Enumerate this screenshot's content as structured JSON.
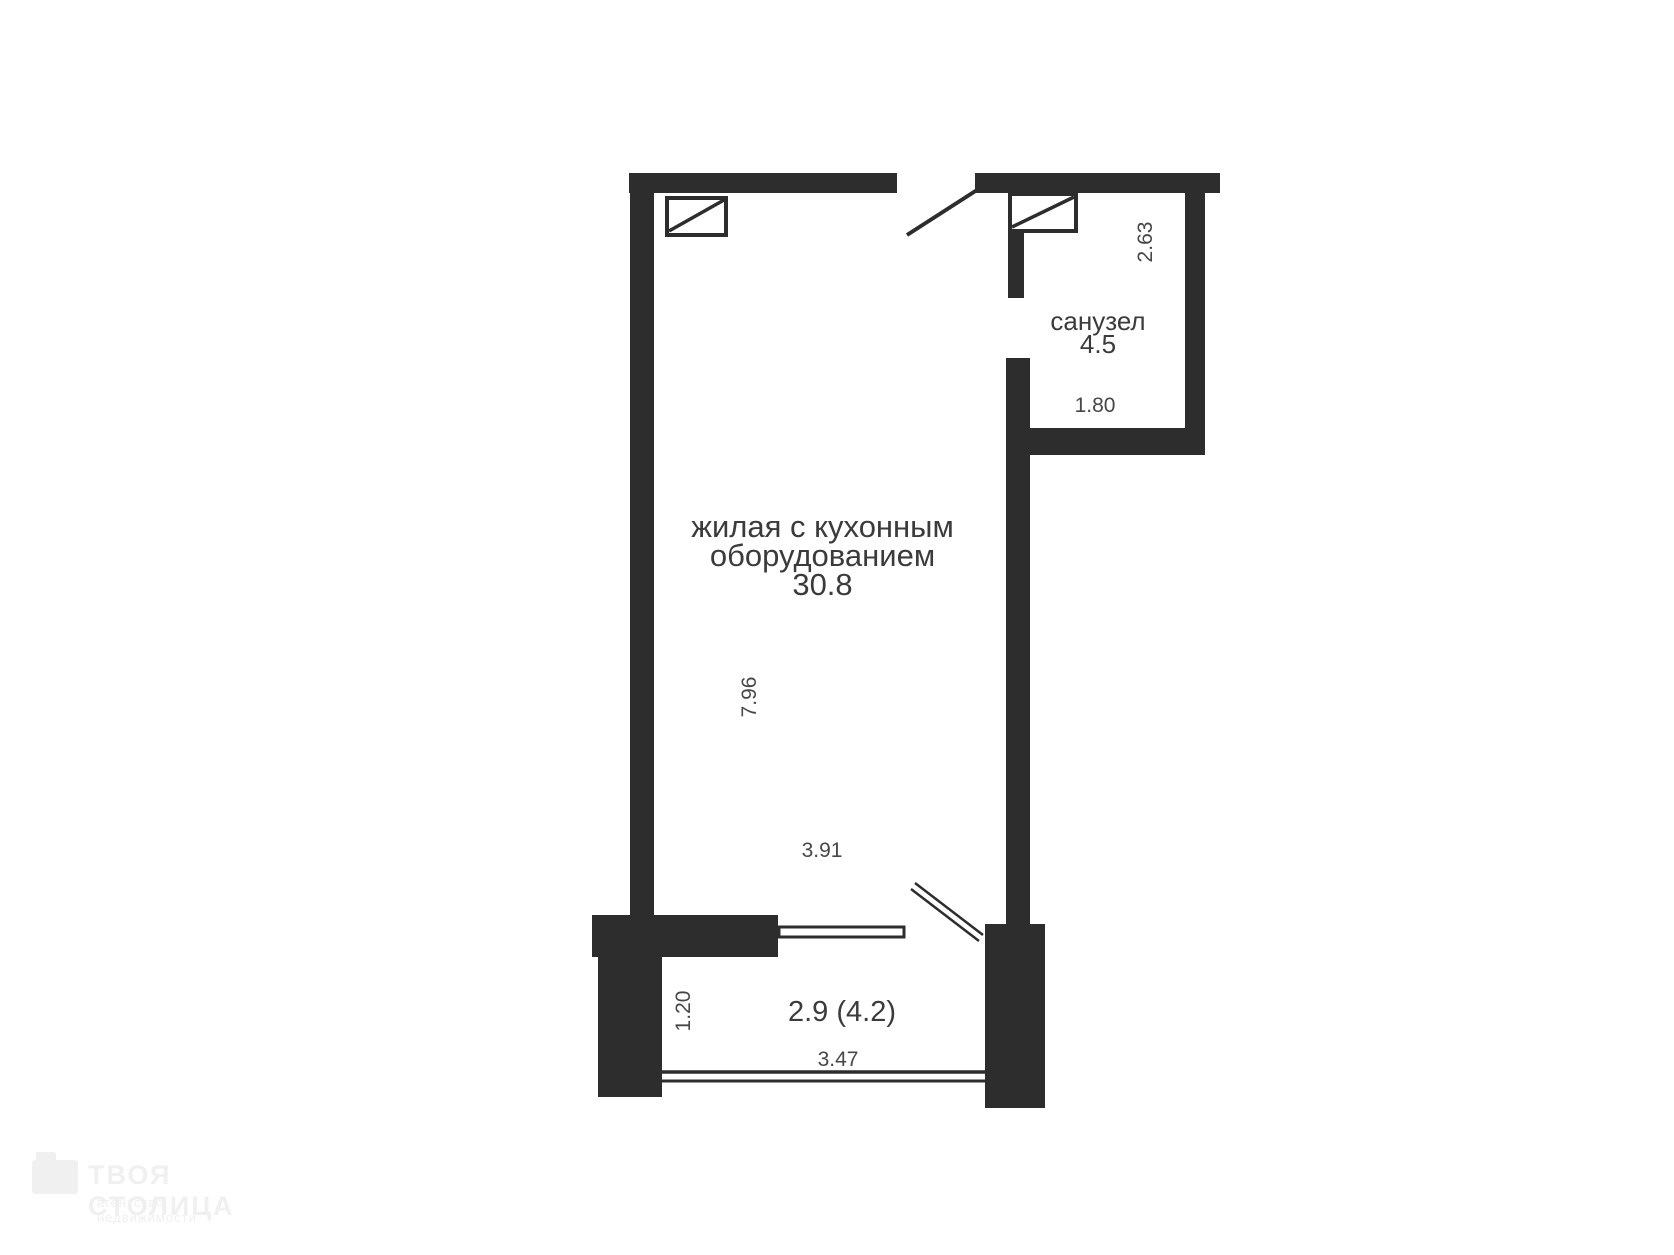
{
  "plan": {
    "rooms": {
      "living": {
        "name_line1": "жилая с кухонным",
        "name_line2": "оборудованием",
        "area": "30.8"
      },
      "bathroom": {
        "name": "санузел",
        "area": "4.5"
      },
      "balcony": {
        "area": "2.9 (4.2)"
      }
    },
    "dimensions": {
      "living_depth": "7.96",
      "living_width": "3.91",
      "bathroom_depth": "2.63",
      "bathroom_width": "1.80",
      "balcony_depth": "1.20",
      "balcony_width": "3.47"
    }
  },
  "watermark": {
    "brand": "ТВОЯ СТОЛИЦА",
    "tagline": "агентство недвижимости"
  },
  "colors": {
    "wall": "#2d2d2d",
    "room_label": "#3b3b3b",
    "dimension_label": "#474747",
    "background": "#ffffff",
    "watermark": "#f0f0f0"
  }
}
